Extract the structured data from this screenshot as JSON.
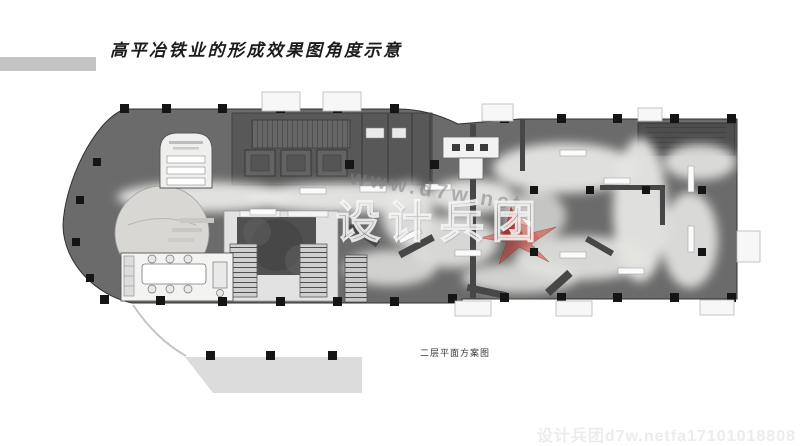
{
  "header": {
    "title": "高平冶铁业的形成效果图角度示意"
  },
  "plan": {
    "caption": "二层平面方案图",
    "watermark_center_url": "www.d7w.net",
    "watermark_center_brand": "设计兵团",
    "watermark_bottom": "设计兵团d7w.netfa17101018808",
    "colors": {
      "wall_gray": "#6b6b6b",
      "core_gray": "#585858",
      "column_black": "#151515",
      "path_light": "#e8e8e6",
      "courtyard_dark": "#4f4f4f",
      "terrace_gray": "#dcdcdc",
      "view_marker_red": "#cc2a1e",
      "title_bar_gray": "#c3c3c3"
    }
  }
}
